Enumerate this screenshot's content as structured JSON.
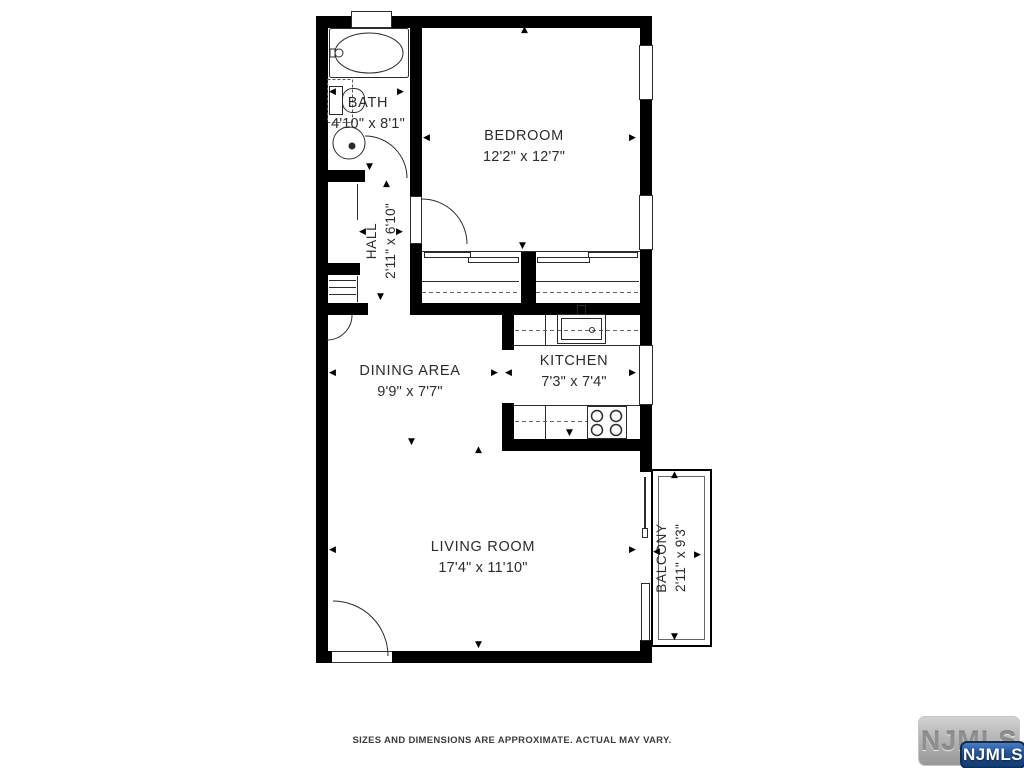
{
  "plan": {
    "rooms": [
      {
        "name": "BATH",
        "dims": "4'10\" x 8'1\""
      },
      {
        "name": "BEDROOM",
        "dims": "12'2\" x 12'7\""
      },
      {
        "name": "HALL",
        "dims": "2'11\" x 6'10\""
      },
      {
        "name": "DINING AREA",
        "dims": "9'9\" x 7'7\""
      },
      {
        "name": "KITCHEN",
        "dims": "7'3\" x 7'4\""
      },
      {
        "name": "LIVING ROOM",
        "dims": "17'4\" x 11'10\""
      },
      {
        "name": "BALCONY",
        "dims": "2'11\" x 9'3\""
      }
    ]
  },
  "icons": {
    "arrow_up": "▲",
    "arrow_down": "▼",
    "arrow_left": "◀",
    "arrow_right": "▶"
  },
  "footer": {
    "disclaimer": "SIZES AND DIMENSIONS ARE APPROXIMATE. ACTUAL MAY VARY."
  },
  "watermark": {
    "plate_text": "NJMLS",
    "badge_text": "NJMLS"
  },
  "colors": {
    "wall": "#000000",
    "line": "#2b2b2b",
    "text": "#2c2c2c",
    "badge_blue": "#1c4a87",
    "plate_gray": "#b5b5b5"
  }
}
